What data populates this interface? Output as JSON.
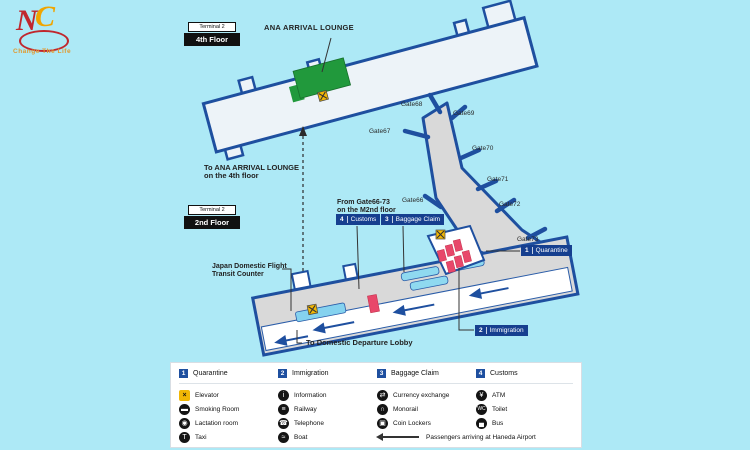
{
  "logo": {
    "letter_n": "N",
    "letter_c": "C",
    "tagline": "Change The Life"
  },
  "floor4": {
    "terminal_chip": "Terminal 2",
    "floor_chip": "4th Floor",
    "lounge_label": "ANA ARRIVAL LOUNGE"
  },
  "floor2": {
    "terminal_chip": "Terminal 2",
    "floor_chip": "2nd Floor",
    "to_ana_line1": "To ANA ARRIVAL LOUNGE",
    "to_ana_line2": "on the 4th floor",
    "from_gates_line1": "From Gate66-73",
    "from_gates_line2": "on the M2nd floor",
    "transit_line1": "Japan Domestic Flight",
    "transit_line2": "Transit Counter",
    "to_domestic_label": "To Domestic Departure Lobby",
    "gates": {
      "g66": "Gate66",
      "g67": "Gate67",
      "g68": "Gate68",
      "g69": "Gate69",
      "g70": "Gate70",
      "g71": "Gate71",
      "g72": "Gate72",
      "g73": "Gate73"
    },
    "badges": {
      "quarantine": {
        "num": "1",
        "label": "Quarantine"
      },
      "immigration": {
        "num": "2",
        "label": "Immigration"
      },
      "baggage": {
        "num": "3",
        "label": "Baggage Claim"
      },
      "customs": {
        "num": "4",
        "label": "Customs"
      }
    }
  },
  "legend": {
    "headers": [
      {
        "num": "1",
        "label": "Quarantine"
      },
      {
        "num": "2",
        "label": "Immigration"
      },
      {
        "num": "3",
        "label": "Baggage Claim"
      },
      {
        "num": "4",
        "label": "Customs"
      }
    ],
    "items": [
      {
        "icon": "elevator",
        "glyph": "×",
        "label": "Elevator"
      },
      {
        "icon": "information",
        "glyph": "i",
        "label": "Information"
      },
      {
        "icon": "currency-exchange",
        "glyph": "⇄",
        "label": "Currency exchange"
      },
      {
        "icon": "atm",
        "glyph": "¥",
        "label": "ATM"
      },
      {
        "icon": "smoking-room",
        "glyph": "▬",
        "label": "Smoking Room"
      },
      {
        "icon": "railway",
        "glyph": "≡",
        "label": "Railway"
      },
      {
        "icon": "monorail",
        "glyph": "∩",
        "label": "Monorail"
      },
      {
        "icon": "toilet",
        "glyph": "WC",
        "label": "Toilet"
      },
      {
        "icon": "lactation-room",
        "glyph": "◉",
        "label": "Lactation room"
      },
      {
        "icon": "telephone",
        "glyph": "☎",
        "label": "Telephone"
      },
      {
        "icon": "coin-lockers",
        "glyph": "▣",
        "label": "Coin Lockers"
      },
      {
        "icon": "bus",
        "glyph": "▄",
        "label": "Bus"
      },
      {
        "icon": "taxi",
        "glyph": "T",
        "label": "Taxi"
      },
      {
        "icon": "boat",
        "glyph": "≈",
        "label": "Boat"
      }
    ],
    "arrow_note": "Passengers arriving at Haneda Airport"
  },
  "colors": {
    "background": "#ade9f6",
    "outline_blue": "#1e4f9f",
    "badge_navy": "#163f8f",
    "lounge_green": "#21993c",
    "belt_cyan": "#8fd9f0",
    "counter_red": "#e8476a",
    "elevator_yellow": "#f2b705"
  }
}
